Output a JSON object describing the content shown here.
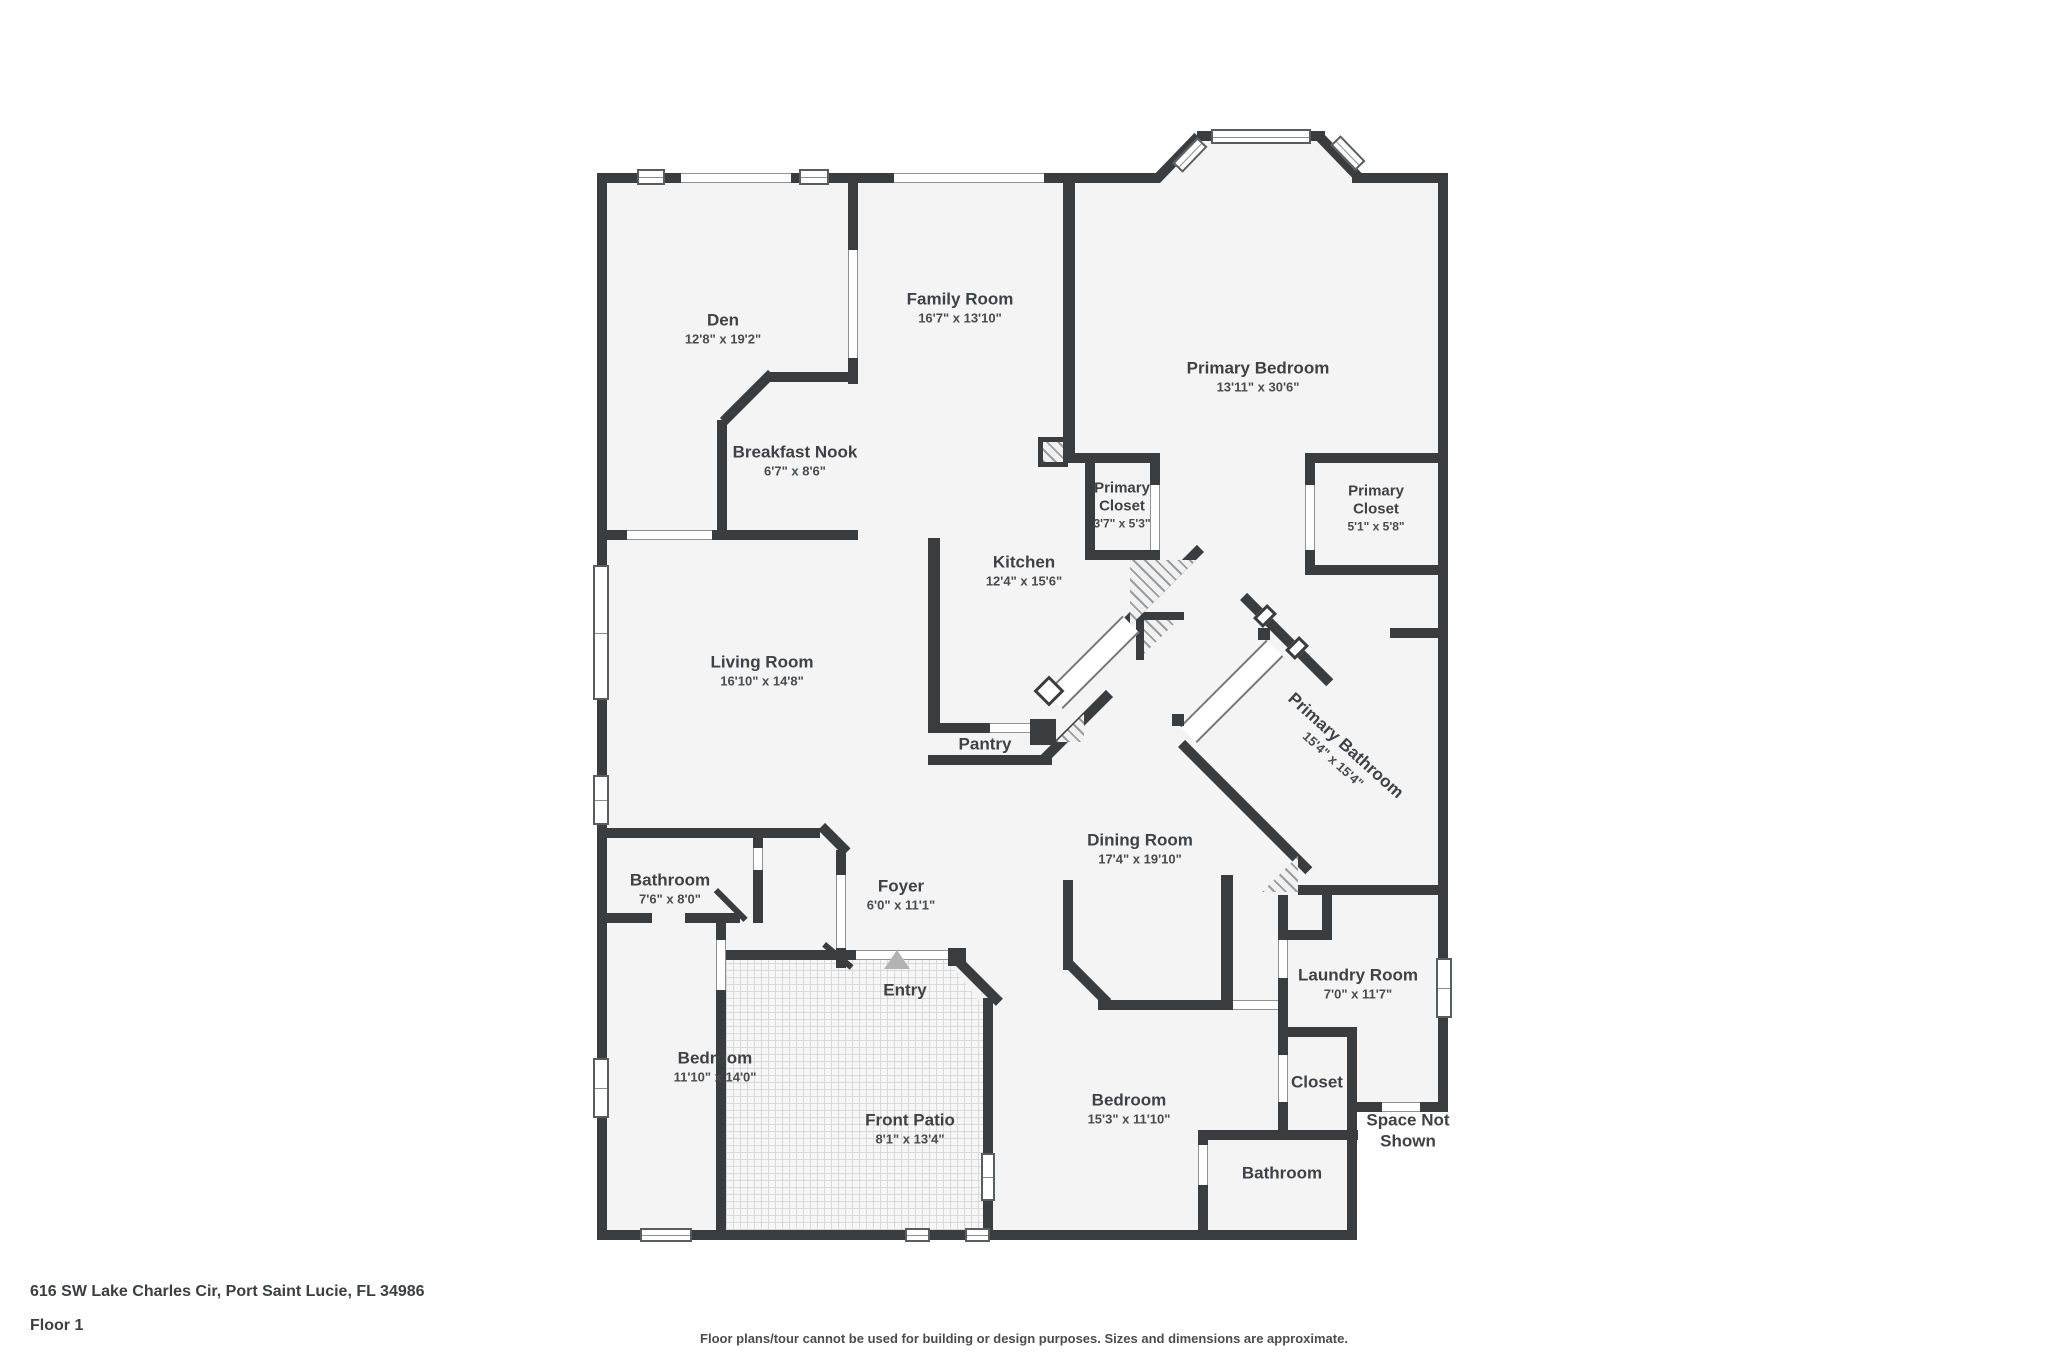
{
  "colors": {
    "wall": "#3a3d40",
    "floor": "#f4f4f4",
    "label_text": "#3e4246"
  },
  "rooms": {
    "den": {
      "label": "Den",
      "dims": "12'8\" x 19'2\""
    },
    "family_room": {
      "label": "Family Room",
      "dims": "16'7\" x 13'10\""
    },
    "primary_bedroom": {
      "label": "Primary Bedroom",
      "dims": "13'11\" x 30'6\""
    },
    "breakfast_nook": {
      "label": "Breakfast Nook",
      "dims": "6'7\" x 8'6\""
    },
    "primary_closet_1": {
      "label": "Primary Closet",
      "dims": "3'7\" x 5'3\""
    },
    "primary_closet_2": {
      "label": "Primary Closet",
      "dims": "5'1\" x 5'8\""
    },
    "kitchen": {
      "label": "Kitchen",
      "dims": "12'4\" x 15'6\""
    },
    "living_room": {
      "label": "Living Room",
      "dims": "16'10\" x 14'8\""
    },
    "pantry": {
      "label": "Pantry",
      "dims": ""
    },
    "primary_bathroom": {
      "label": "Primary Bathroom",
      "dims": "15'4\" x 15'4\""
    },
    "dining_room": {
      "label": "Dining Room",
      "dims": "17'4\" x 19'10\""
    },
    "bathroom_1": {
      "label": "Bathroom",
      "dims": "7'6\" x 8'0\""
    },
    "foyer": {
      "label": "Foyer",
      "dims": "6'0\" x 11'1\""
    },
    "laundry_room": {
      "label": "Laundry Room",
      "dims": "7'0\" x 11'7\""
    },
    "bedroom_1": {
      "label": "Bedroom",
      "dims": "11'10\" x 14'0\""
    },
    "bedroom_2": {
      "label": "Bedroom",
      "dims": "15'3\" x 11'10\""
    },
    "front_patio": {
      "label": "Front Patio",
      "dims": "8'1\" x 13'4\""
    },
    "entry": {
      "label": "Entry",
      "dims": ""
    },
    "closet": {
      "label": "Closet",
      "dims": ""
    },
    "bathroom_2": {
      "label": "Bathroom",
      "dims": ""
    },
    "space_not_shown": {
      "label": "Space Not Shown",
      "dims": ""
    }
  },
  "footer": {
    "address": "616 SW Lake Charles Cir, Port Saint Lucie, FL 34986",
    "floor": "Floor 1",
    "disclaimer": "Floor plans/tour cannot be used for building or design purposes. Sizes and dimensions are approximate."
  }
}
